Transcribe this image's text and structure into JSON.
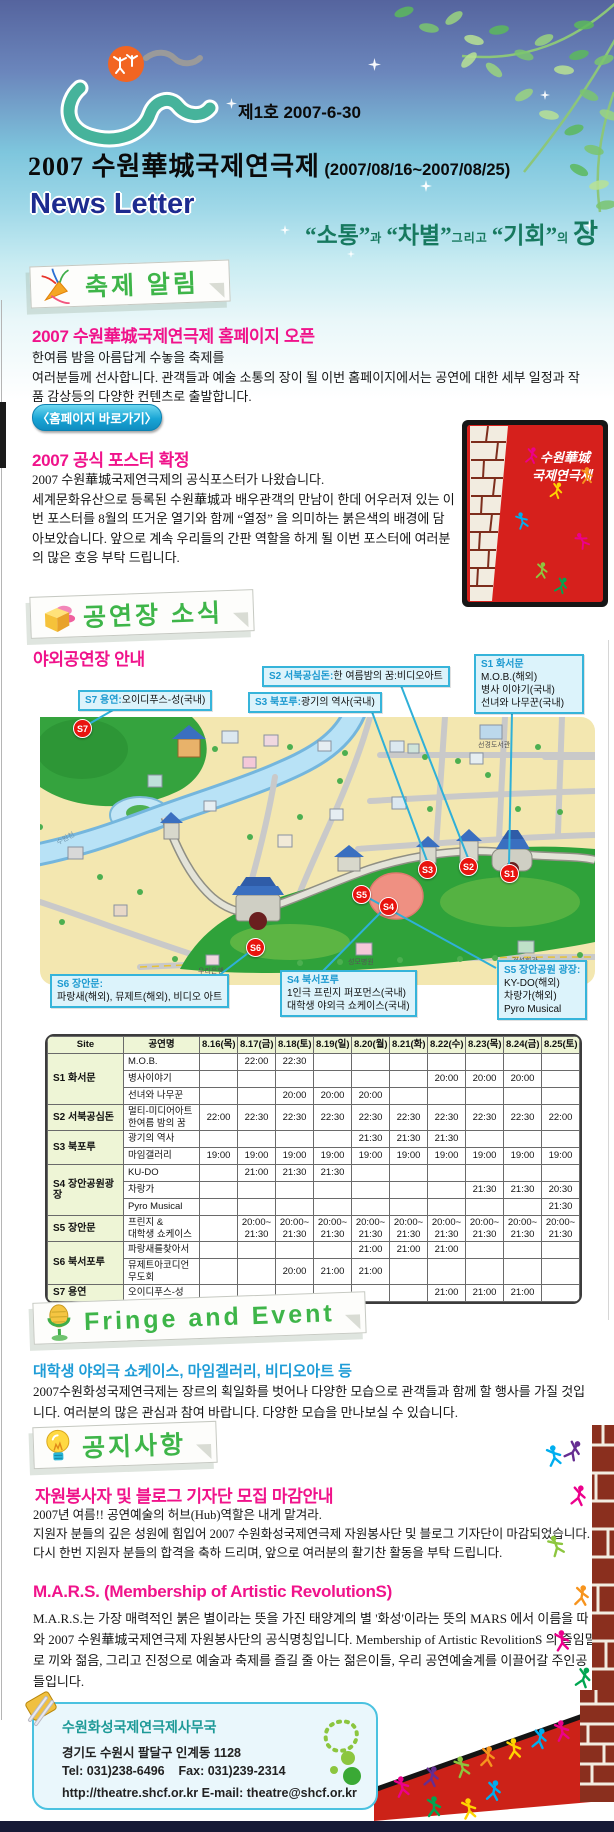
{
  "header": {
    "issue_label": "제1호 2007-6-30",
    "title": "2007 수원華城국제연극제",
    "title_dates": "(2007/08/16~2007/08/25)",
    "newsletter_label": "News Letter",
    "tagline": {
      "w1": "“소통”",
      "j1": "과",
      "w2": "“차별”",
      "j2": "그리고",
      "w3": "“기회”",
      "j3": "의",
      "w4": "장"
    }
  },
  "festival_news": {
    "section_label": "축제 알림",
    "article1": {
      "title": "2007 수원華城국제연극제 홈페이지 오픈",
      "line1": "한여름 밤을 아름답게 수놓을 축제를",
      "line2": "여러분들께 선사합니다.  관객들과 예술 소통의 장이 될 이번 홈페이지에서는 공연에 대한 세부 일정과 작품 감상등의 다양한 컨텐츠로 출발합니다.",
      "button_label": "〈홈페이지 바로가기〉"
    },
    "article2": {
      "title": "2007 공식 포스터 확정",
      "line1": "2007 수원華城국제연극제의 공식포스터가 나왔습니다.",
      "body": "세계문화유산으로 등록된 수원華城과 배우관객의 만남이 한데 어우러져 있는 이번 포스터를 8월의 뜨거운 열기와 함께 “열정” 을 의미하는 붉은색의 배경에 담아보았습니다. 앞으로 계속 우리들의 간판 역할을 하게 될 이번 포스터에 여러분의 많은 호응 부탁 드립니다.",
      "poster_caption_line1": "수원華城",
      "poster_caption_line2": "국제연극제"
    }
  },
  "venue_news": {
    "section_label": "공연장 소식",
    "subtitle": "야외공연장 안내",
    "map": {
      "markers": [
        "S1",
        "S2",
        "S3",
        "S4",
        "S5",
        "S6",
        "S7"
      ],
      "callouts": {
        "s7": {
          "head": "S7 용연:",
          "lines": [
            "오이디푸스-성(국내)"
          ]
        },
        "s2": {
          "head": "S2 서북공심돈:",
          "lines": [
            "한 여름밤의 꿈:비디오아트"
          ]
        },
        "s3": {
          "head": "S3 북포루:",
          "lines": [
            "광기의 역사(국내)"
          ]
        },
        "s1": {
          "head": "S1 화서문",
          "lines": [
            "M.O.B.(해외)",
            "병사 이야기(국내)",
            "선녀와 나무꾼(국내)"
          ]
        },
        "s6": {
          "head": "S6 장안문:",
          "lines": [
            "파랑새(해외), 뮤제트(해외), 비디오 아트"
          ]
        },
        "s4": {
          "head": "S4 북서포루",
          "lines": [
            "1인극 프린지 퍼포먼스(국내)",
            "대학생 야외극 쇼케이스(국내)"
          ]
        },
        "s5": {
          "head": "S5 장안공원 광장:",
          "lines": [
            "KY-DO(해외)",
            "차랑가(해외)",
            "Pyro Musical"
          ]
        }
      },
      "labels": {
        "river": "수원천",
        "library": "선경도서관",
        "hospital": "성모병원",
        "hall": "건설회관",
        "bank": "우리은행",
        "station": "수원역"
      }
    }
  },
  "schedule": {
    "columns": [
      "Site",
      "공연명",
      "8.16(목)",
      "8.17(금)",
      "8.18(토)",
      "8.19(일)",
      "8.20(월)",
      "8.21(화)",
      "8.22(수)",
      "8.23(목)",
      "8.24(금)",
      "8.25(토)"
    ],
    "rows": [
      {
        "site": "S1 화서문",
        "span": 3,
        "show": "M.O.B.",
        "times": [
          "",
          "22:00",
          "22:30",
          "",
          "",
          "",
          "",
          "",
          "",
          ""
        ]
      },
      {
        "show": "병사이야기",
        "times": [
          "",
          "",
          "",
          "",
          "",
          "",
          "20:00",
          "20:00",
          "20:00",
          ""
        ]
      },
      {
        "show": "선녀와 나무꾼",
        "times": [
          "",
          "",
          "20:00",
          "20:00",
          "20:00",
          "",
          "",
          "",
          "",
          ""
        ]
      },
      {
        "site": "S2 서북공심돈",
        "span": 1,
        "show": "멀티-미디어아트\n한여름 밤의 꿈",
        "times": [
          "22:00",
          "22:30",
          "22:30",
          "22:30",
          "22:30",
          "22:30",
          "22:30",
          "22:30",
          "22:30",
          "22:00"
        ]
      },
      {
        "site": "S3 북포루",
        "span": 2,
        "show": "광기의 역사",
        "times": [
          "",
          "",
          "",
          "",
          "21:30",
          "21:30",
          "21:30",
          "",
          "",
          ""
        ]
      },
      {
        "show": "마임갤러리",
        "times": [
          "19:00",
          "19:00",
          "19:00",
          "19:00",
          "19:00",
          "19:00",
          "19:00",
          "19:00",
          "19:00",
          "19:00"
        ]
      },
      {
        "site": "S4 장안공원광장",
        "span": 3,
        "show": "KU-DO",
        "times": [
          "",
          "21:00",
          "21:30",
          "21:30",
          "",
          "",
          "",
          "",
          "",
          ""
        ]
      },
      {
        "show": "차랑가",
        "times": [
          "",
          "",
          "",
          "",
          "",
          "",
          "",
          "21:30",
          "21:30",
          "20:30"
        ]
      },
      {
        "show": "Pyro Musical",
        "times": [
          "",
          "",
          "",
          "",
          "",
          "",
          "",
          "",
          "",
          "21:30"
        ]
      },
      {
        "site": "S5 장안문",
        "span": 1,
        "show": "프린지 &\n대학생 쇼케이스",
        "times": [
          "",
          "20:00~\n21:30",
          "20:00~\n21:30",
          "20:00~\n21:30",
          "20:00~\n21:30",
          "20:00~\n21:30",
          "20:00~\n21:30",
          "20:00~\n21:30",
          "20:00~\n21:30",
          "20:00~\n21:30"
        ]
      },
      {
        "site": "S6 북서포루",
        "span": 2,
        "show": "파랑새를찾아서",
        "times": [
          "",
          "",
          "",
          "",
          "21:00",
          "21:00",
          "21:00",
          "",
          "",
          ""
        ]
      },
      {
        "show": "뮤제트아코디언\n무도회",
        "times": [
          "",
          "",
          "20:00",
          "21:00",
          "21:00",
          "",
          "",
          "",
          "",
          ""
        ]
      },
      {
        "site": "S7 용연",
        "span": 1,
        "show": "오이디푸스-성",
        "times": [
          "",
          "",
          "",
          "",
          "",
          "",
          "21:00",
          "21:00",
          "21:00",
          ""
        ]
      }
    ]
  },
  "fringe": {
    "section_label": "Fringe and Event",
    "title": "대학생 야외극 쇼케이스, 마임겔러리, 비디오아트 등",
    "body": "2007수원화성국제연극제는 장르의 획일화를 벗어나 다양한 모습으로 관객들과 함께 할 행사를 가질 것입니다. 여러분의 많은 관심과 참여 바랍니다. 다양한 모습을 만나보실 수 있습니다."
  },
  "notice": {
    "section_label": "공지사항",
    "notice1_title": "자원봉사자 및 블로그 기자단 모집 마감안내",
    "notice1_line1": "2007년 여름!! 공연예술의 허브(Hub)역할은 내게 맡겨라.",
    "notice1_body": "지원자 분들의 깊은 성원에 힘입어 2007 수원화성국제연극제 자원봉사단 및 블로그 기자단이 마감되었습니다. 다시 한번 지원자 분들의 합격을 축하 드리며, 앞으로 여러분의 활기찬 활동을 부탁 드립니다.",
    "mars_title": "M.A.R.S. (Membership of Artistic RevolutionS)",
    "mars_body": "M.A.R.S.는 가장 매력적인 붉은 별이라는 뜻을 가진 태양계의 별 '화성'이라는 뜻의 MARS 에서 이름을 따와 2007 수원華城국제연극제 자원봉사단의 공식명칭입니다. Membership of Artistic RevolitionS 의 줄임말로 끼와 젊음, 그리고 진정으로 예술과 축제를 즐길 줄 아는 젊은이들, 우리 공연예술계를 이끌어갈 주인공 들입니다."
  },
  "footer": {
    "org": "수원화성국제연극제사무국",
    "address": "경기도 수원시 팔달구 인계동 1128",
    "tel_label": "Tel: 031)238-6496",
    "fax_label": "Fax: 031)239-2314",
    "web": "http://theatre.shcf.or.kr",
    "email_label": "E-mail: theatre@shcf.or.kr"
  },
  "colors": {
    "accent_green": "#3eb549",
    "accent_pink": "#f0138b",
    "accent_blue": "#1e9cd7",
    "callout_border": "#36b4da",
    "marker_red": "#e8140f",
    "tagline_teal": "#17795f"
  }
}
